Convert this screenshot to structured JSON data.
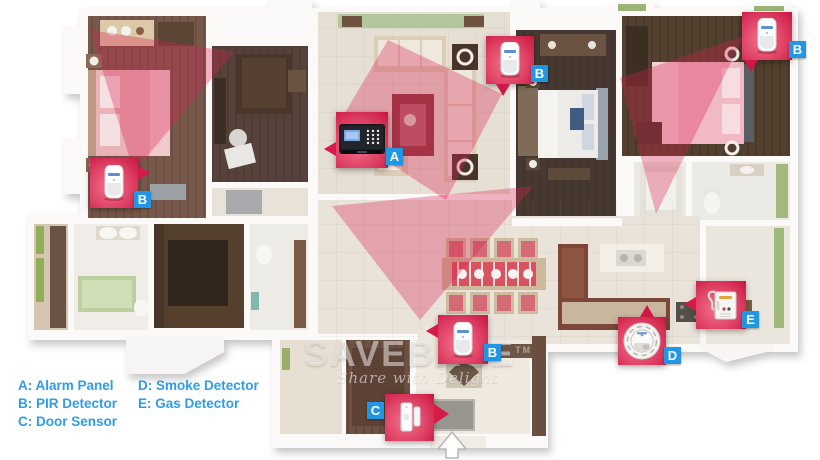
{
  "legend": {
    "text_color": "#2f9ce8",
    "items": [
      {
        "text": "A: Alarm Panel"
      },
      {
        "text": "B: PIR Detector"
      },
      {
        "text": "C: Door Sensor"
      },
      {
        "text": "D: Smoke Detector"
      },
      {
        "text": "E: Gas Detector"
      }
    ]
  },
  "watermark": {
    "brand": "SAVEBASE",
    "tm": "TM",
    "tagline": "Share with Delight"
  },
  "markers": [
    {
      "letter": "A",
      "device": "alarm-panel",
      "location": "living-room-wall"
    },
    {
      "letter": "B",
      "device": "pir-detector",
      "location": "living-room"
    },
    {
      "letter": "B",
      "device": "pir-detector",
      "location": "right-bedroom"
    },
    {
      "letter": "B",
      "device": "pir-detector",
      "location": "left-bedroom"
    },
    {
      "letter": "B",
      "device": "pir-detector",
      "location": "dining-area"
    },
    {
      "letter": "C",
      "device": "door-sensor",
      "location": "entrance"
    },
    {
      "letter": "D",
      "device": "smoke-detector",
      "location": "kitchen"
    },
    {
      "letter": "E",
      "device": "gas-detector",
      "location": "kitchen-wall"
    }
  ],
  "icons": {
    "entrance": "entrance-arrow-up"
  },
  "colors": {
    "marker_pink": "#d6204b",
    "marker_pink_light": "#ef7187",
    "label_blue": "#2196e3",
    "legend_blue": "#2f9ce8",
    "beam_red": "#d92050"
  }
}
